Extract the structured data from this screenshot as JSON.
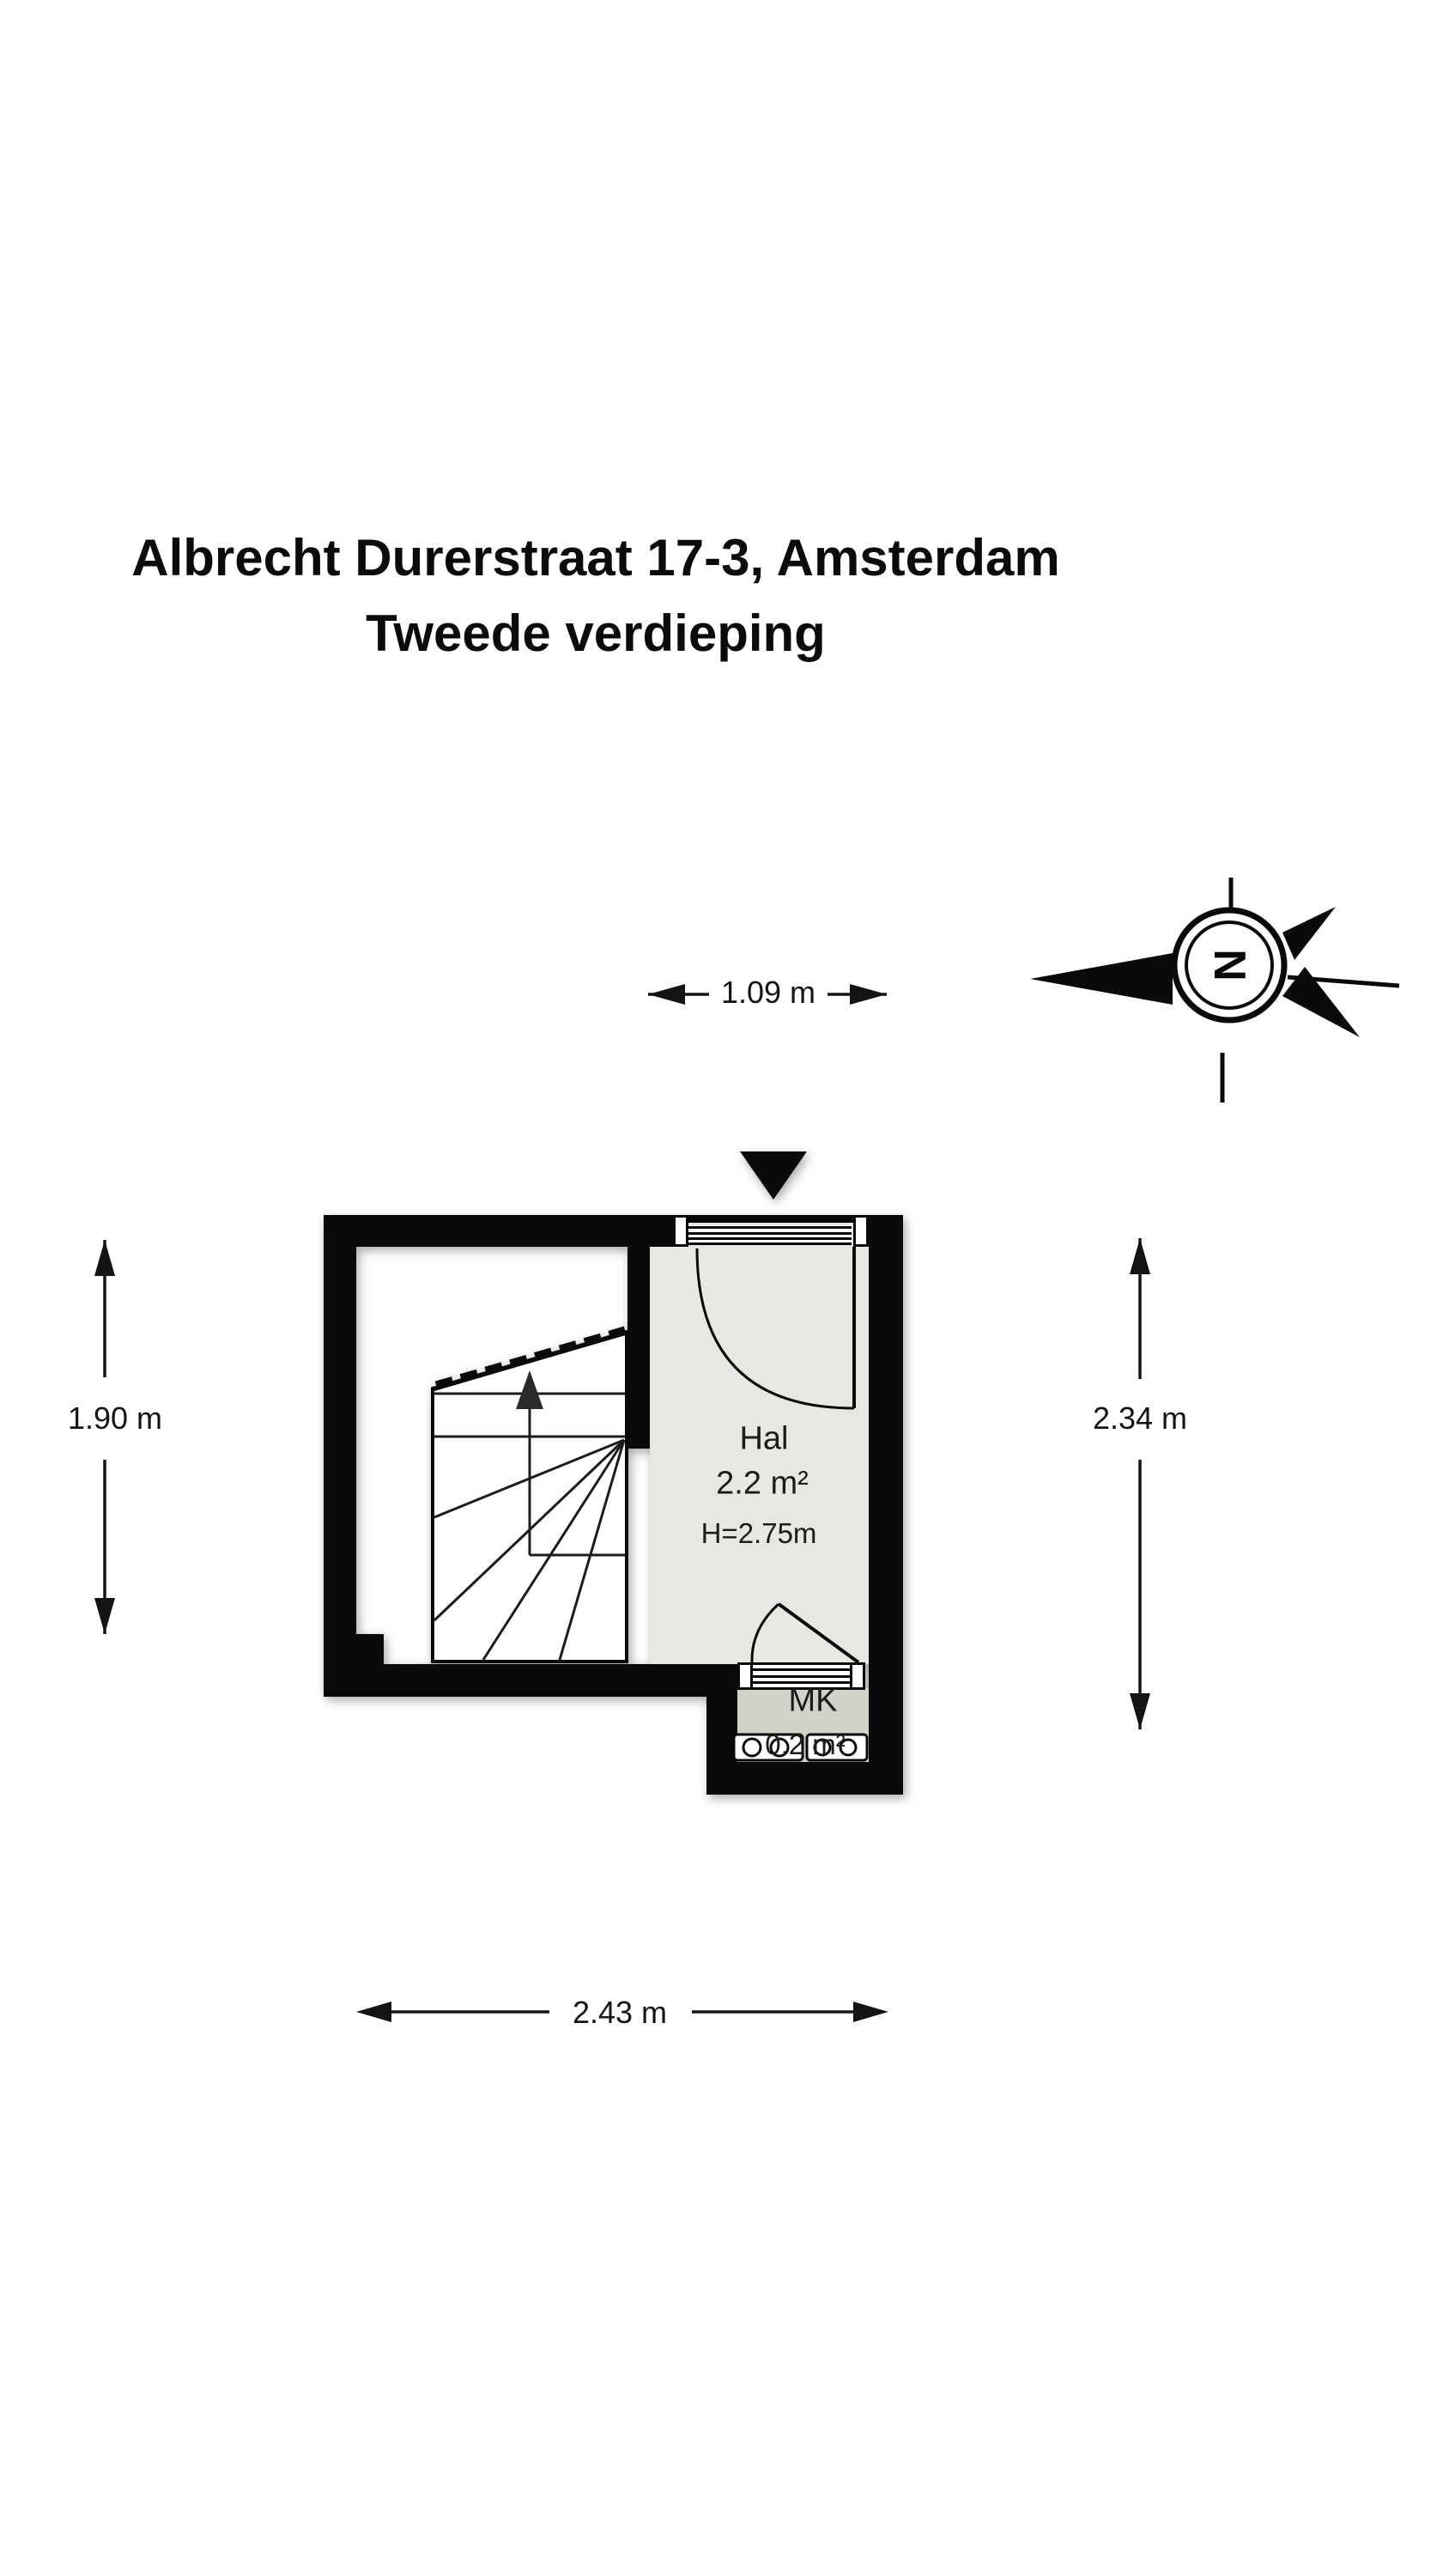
{
  "title": {
    "line1": "Albrecht Durerstraat 17-3, Amsterdam",
    "line2": "Tweede verdieping"
  },
  "compass": {
    "north_label": "N"
  },
  "rooms": {
    "hal": {
      "name": "Hal",
      "area": "2.2 m²",
      "ceiling_height": "H=2.75m"
    },
    "mk": {
      "name": "MK",
      "area": "0.2 m²"
    }
  },
  "dimensions": {
    "top_width": "1.09 m",
    "left_height": "1.90 m",
    "right_height": "2.34 m",
    "bottom_width": "2.43 m"
  },
  "colors": {
    "wall": "#0a0a0a",
    "hal_floor": "#e9e7e1",
    "mk_floor": "#d2d1ca",
    "text": "#141414"
  }
}
